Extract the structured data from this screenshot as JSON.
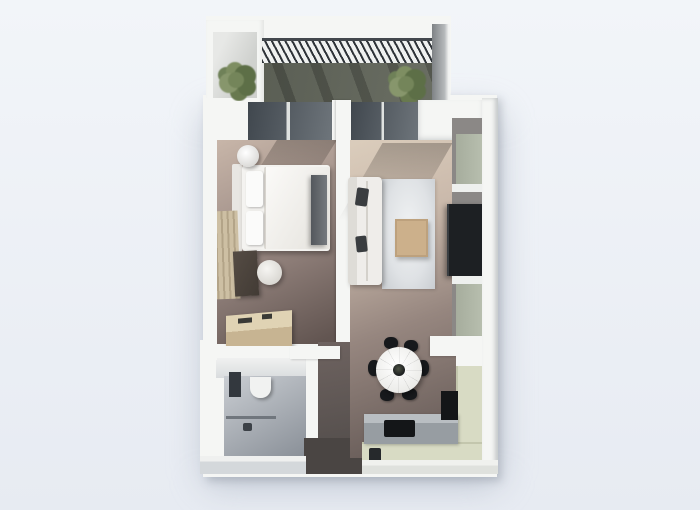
{
  "meta": {
    "description": "Top-down 3D architectural render of a one-bedroom apartment floor plan on a plain light background. No text, labels or UI controls are visible in the image.",
    "view": "top-down axonometric 3D render",
    "visible_text": ""
  },
  "palette": {
    "background_top": "#f2f5f9",
    "background_bottom": "#e7ebf2",
    "model_shadow": "rgba(168,177,191,0.55)",
    "wall_white": "#f5f6f4",
    "wall_shade": "#d4d8db",
    "balcony_floor_dark": "#565a50",
    "balcony_floor_light": "#6a6e63",
    "railing_slat": "#2f3439",
    "glass_dark": "#40474e",
    "glass_light": "#6e757b",
    "plant_green": "#74855a",
    "plant_green_dark": "#5d6f47",
    "bedroom_floor_light": "#c8b6a9",
    "bedroom_floor_dark": "#625551",
    "bed_white": "#f4f3f0",
    "pillow_white": "#fbfbfa",
    "bedroom_tv_gray": "#75797e",
    "rug_bedroom_beige": "#cdbfa3",
    "rug_bedroom_line": "#b3a488",
    "desk_dark_wood": "#423b35",
    "chair_white": "#d9d7d2",
    "dresser_wood": "#c7b492",
    "bath_floor_light": "#c9cdd2",
    "bath_floor_dark": "#8c929a",
    "bath_window_slot": "#33383e",
    "toilet_white": "#f1f2f1",
    "hall_floor_light": "#6e6360",
    "hall_floor_dark": "#514c4a",
    "entry_floor": "#4a4543",
    "living_floor_light": "#dbcdbc",
    "living_floor_dark": "#6c605c",
    "sofa_white": "#efedea",
    "sofa_pillow_dark": "#3a3d40",
    "rug_living_gray": "#dfe2e5",
    "coffee_table_tan": "#ccb08b",
    "media_wall_taupe": "#8b8886",
    "media_panel_sage": "#b7beae",
    "tv_black": "#1d2023",
    "dining_table_white": "#ebebe8",
    "dining_vase_dark": "#17191c",
    "dining_chair_black": "#17191c",
    "kitchen_counter_sage": "#d8dbc4",
    "kitchen_counter_gray": "#979da2",
    "appliance_black": "#141618"
  },
  "scene": {
    "rooms": [
      {
        "name": "balcony",
        "position": "top",
        "items": [
          "slatted railing",
          "left planter plant",
          "right planter plant",
          "sliding glass door to bedroom",
          "sliding glass door to living room",
          "white parapet walls"
        ]
      },
      {
        "name": "bedroom",
        "position": "left",
        "items": [
          "double bed with two pillows",
          "round bedside table",
          "wall tv panel",
          "striped beige runner rug",
          "dark wood desk",
          "white round chair",
          "wood dresser"
        ]
      },
      {
        "name": "living-room",
        "position": "right",
        "items": [
          "white sofa with dark throw pillows",
          "large light gray area rug",
          "tan coffee table",
          "sage media wall with black tv"
        ]
      },
      {
        "name": "dining-area",
        "position": "center-bottom-right",
        "items": [
          "round white table with dark centerpiece",
          "six black chairs"
        ]
      },
      {
        "name": "kitchen",
        "position": "bottom-right",
        "items": [
          "L-shaped sage counter",
          "gray counter run",
          "black cooktop",
          "black tall appliance",
          "small dark cabinet unit"
        ]
      },
      {
        "name": "bathroom",
        "position": "bottom-left",
        "items": [
          "toilet",
          "shower glass partition",
          "dark wall niche window",
          "gray tiled floor"
        ]
      },
      {
        "name": "hallway-entry",
        "position": "bottom-center",
        "items": [
          "entry door opening in bottom wall",
          "dark taupe corridor floor"
        ]
      }
    ]
  }
}
